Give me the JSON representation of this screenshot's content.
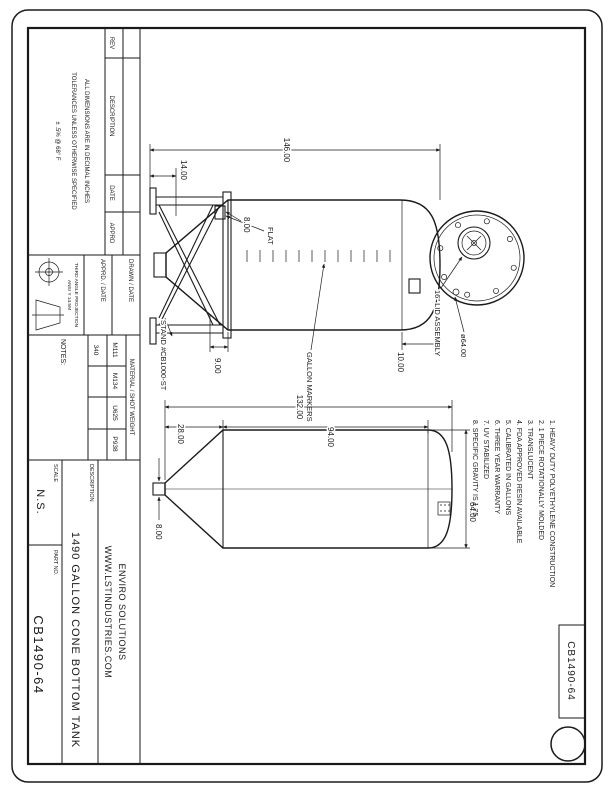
{
  "sheet": {
    "rev_table": {
      "rev": "REV",
      "description": "DESCRIPTION",
      "date": "DATE",
      "apprd": "APPRD"
    },
    "tolerance_note": {
      "line1": "ALL DIMENSIONS ARE IN DECIMAL INCHES",
      "line2": "TOLERANCES UNLESS OTHERWISE SPECIFIED",
      "line3": "± .5% @ 68° F"
    },
    "approval": {
      "drawn": "DRAWN / DATE",
      "apprd": "APPRD. / DATE"
    },
    "projection": {
      "line1": "THIRD ANGLE PROJECTION",
      "line2": "ANSI Y 14.5M"
    },
    "material_table": {
      "header": "MATERIAL / SHOT WEIGHT",
      "col1": "M111",
      "col2": "M134",
      "col3": "U625",
      "col4": "P938",
      "val1": "340"
    },
    "notes_label": "NOTES:",
    "title_block": {
      "company_line1": "ENVIRO SOLUTIONS",
      "company_line2": "WWW.LSTINDUSTRIES.COM",
      "description_label": "DESCRIPTION",
      "description": "1490 GALLON CONE BOTTOM TANK",
      "scale_label": "SCALE",
      "scale_value": "N.S.",
      "part_label": "PART NO.",
      "part_value": "CB1490-64"
    },
    "corner_tab": {
      "part_value": "CB1490-64"
    }
  },
  "side_view": {
    "dim_overall": "146.00",
    "dim_stand": "14.00",
    "dim_flat": "8.00",
    "flat_label": "FLAT",
    "dim_cone": "9.00",
    "dim_dome": "10.00",
    "stand_label": "STAND #CB1000-ST",
    "markers_label": "GALLON MARKERS"
  },
  "top_view": {
    "lid_label": "16\" LID ASSEMBLY",
    "dia_label": "ø64.00"
  },
  "front_view": {
    "dim_overall": "132.00",
    "dim_cone": "28.00",
    "dim_cyl": "94.00",
    "dim_dia": "64.00",
    "dim_outlet": "8.00"
  },
  "notes": [
    "1. HEAVY DUTY POLYETHYLENE CONSTRUCTION",
    "2. 1 PIECE ROTATIONALLY MOLDED",
    "3. TRANSLUCENT",
    "4. FDA APPROVED RESIN AVAILABLE",
    "5. CALIBRATED IN GALLONS",
    "6. THREE YEAR WARRANTY",
    "7. UV STABILIZED",
    "8. SPECIFIC GRAVITY IS 1.75"
  ],
  "colors": {
    "ink": "#1a1a1a",
    "paper": "#ffffff"
  }
}
